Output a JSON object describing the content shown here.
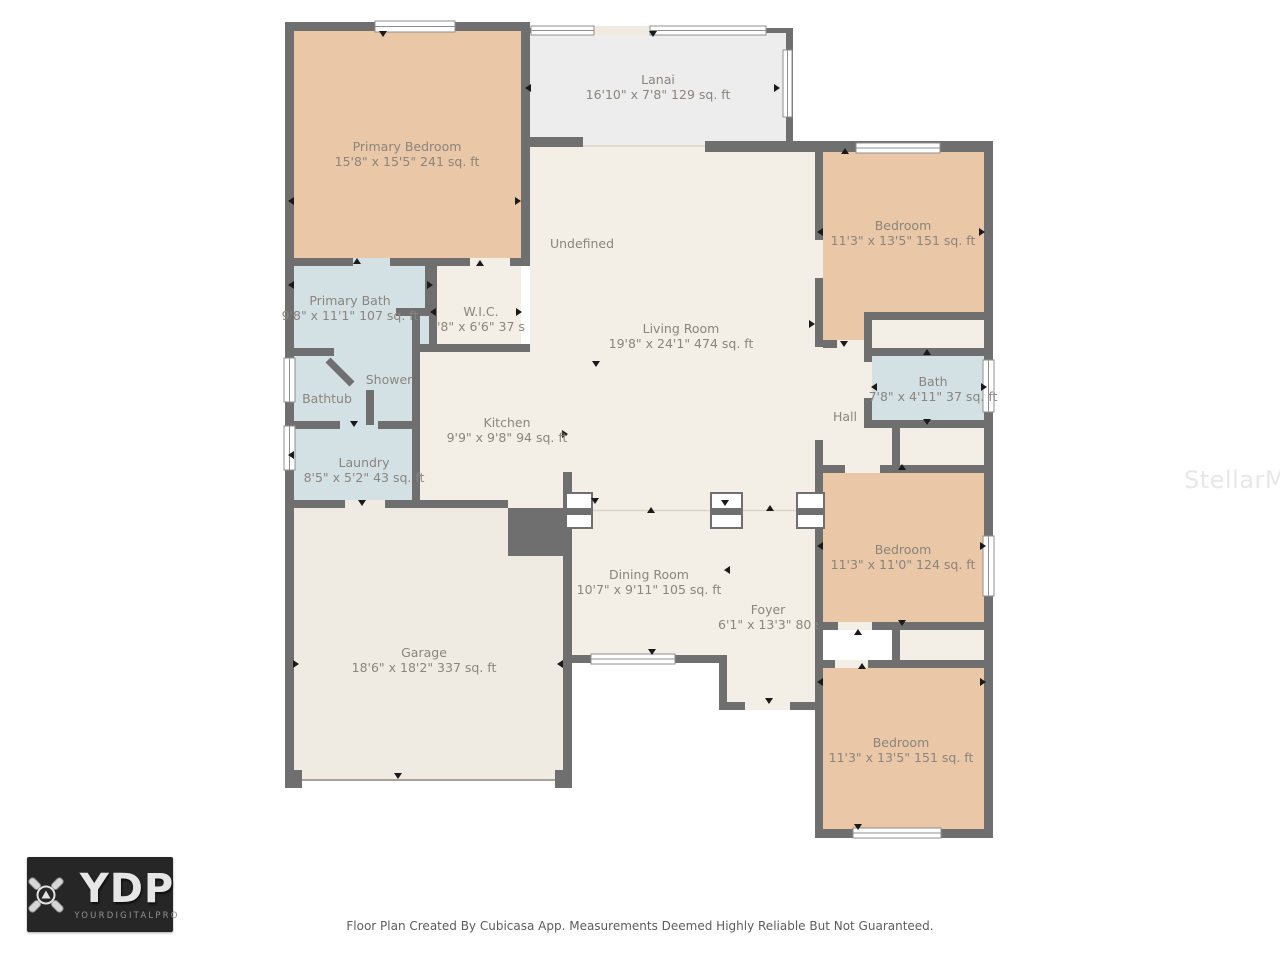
{
  "watermark": {
    "text": "StellarMLS"
  },
  "footer": {
    "disclaimer": "Floor Plan Created By Cubicasa App. Measurements Deemed Highly Reliable But Not Guaranteed."
  },
  "logo": {
    "abbr": "YDP",
    "name": "YOURDIGITALPRO"
  },
  "rooms": {
    "primary_bedroom": {
      "name": "Primary Bedroom",
      "dims": "15'8\" x 15'5\" 241 sq. ft"
    },
    "lanai": {
      "name": "Lanai",
      "dims": "16'10\" x 7'8\" 129 sq. ft"
    },
    "undefined_area": {
      "name": "Undefined"
    },
    "living_room": {
      "name": "Living Room",
      "dims": "19'8\" x 24'1\" 474 sq. ft"
    },
    "bedroom_top_right": {
      "name": "Bedroom",
      "dims": "11'3\" x 13'5\" 151 sq. ft"
    },
    "primary_bath": {
      "name": "Primary Bath",
      "dims": "9'8\" x 11'1\" 107 sq. ft"
    },
    "wic": {
      "name": "W.I.C.",
      "dims": "'8\" x 6'6\" 37 sq. ft"
    },
    "shower": {
      "name": "Shower"
    },
    "bathtub": {
      "name": "Bathtub"
    },
    "kitchen": {
      "name": "Kitchen",
      "dims": "9'9\" x 9'8\" 94 sq. ft"
    },
    "laundry": {
      "name": "Laundry",
      "dims": "8'5\" x 5'2\" 43 sq. ft"
    },
    "hall": {
      "name": "Hall"
    },
    "bath": {
      "name": "Bath",
      "dims": "7'8\" x 4'11\" 37 sq. ft"
    },
    "bedroom_mid_right": {
      "name": "Bedroom",
      "dims": "11'3\" x 11'0\" 124 sq. ft"
    },
    "dining_room": {
      "name": "Dining Room",
      "dims": "10'7\" x 9'11\" 105 sq. ft"
    },
    "foyer": {
      "name": "Foyer",
      "dims": "6'1\" x 13'3\" 80 sq. ft"
    },
    "garage": {
      "name": "Garage",
      "dims": "18'6\" x 18'2\" 337 sq. ft"
    },
    "bedroom_bottom_right": {
      "name": "Bedroom",
      "dims": "11'3\" x 13'5\" 151 sq. ft"
    }
  },
  "colors": {
    "wall": "#6f6f6f",
    "bedroom_fill": "#eac7a6",
    "wet_room_fill": "#d3e1e5",
    "living_fill": "#f4efe6",
    "garage_fill": "#f0ebe2",
    "lanai_fill": "#ededed",
    "label_text": "#8a857d"
  }
}
